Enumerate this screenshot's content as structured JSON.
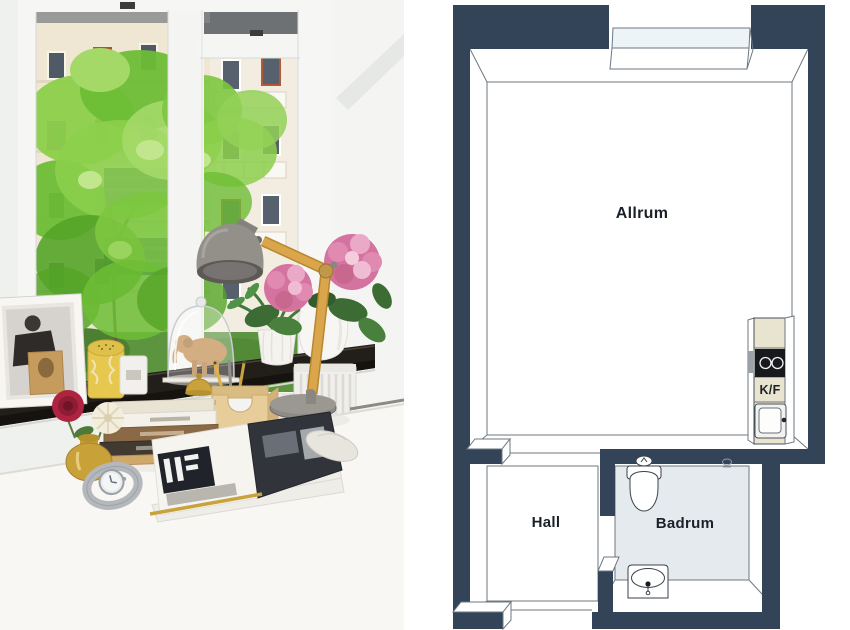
{
  "panels": {
    "photo": {
      "elements": [
        "window",
        "tree-foliage",
        "apartment-buildings",
        "balconies",
        "windowsill",
        "radiator",
        "desk",
        "framed-photo",
        "yellow-candle-jar",
        "white-candle-jar",
        "glass-cloche",
        "elephant-figurine",
        "desk-organizer",
        "brass-bell",
        "pencils",
        "palm-plant",
        "hydrangea-bouquet",
        "white-jug",
        "desk-lamp",
        "book-stack",
        "brass-vase",
        "red-flower",
        "white-flower",
        "wrist-watch",
        "open-magazine",
        "gold-pen"
      ]
    },
    "floor_plan": {
      "rooms": [
        {
          "name": "allrum",
          "label": "Allrum"
        },
        {
          "name": "hall",
          "label": "Hall"
        },
        {
          "name": "badrum",
          "label": "Badrum"
        }
      ],
      "fixtures": {
        "kitchen_label": "K/F",
        "items": [
          "window-bay",
          "kitchen-counter",
          "cooktop",
          "kitchen-sink",
          "toilet",
          "bathroom-sink",
          "floor-drain"
        ]
      },
      "colors": {
        "wall": "#334459",
        "floor": "#ffffff",
        "badrum_floor": "#e5eaef",
        "window_glass": "#edf4f8",
        "counter": "#e8e4d0",
        "outline": "#6e7781",
        "label_text": "#1b2128"
      }
    }
  }
}
